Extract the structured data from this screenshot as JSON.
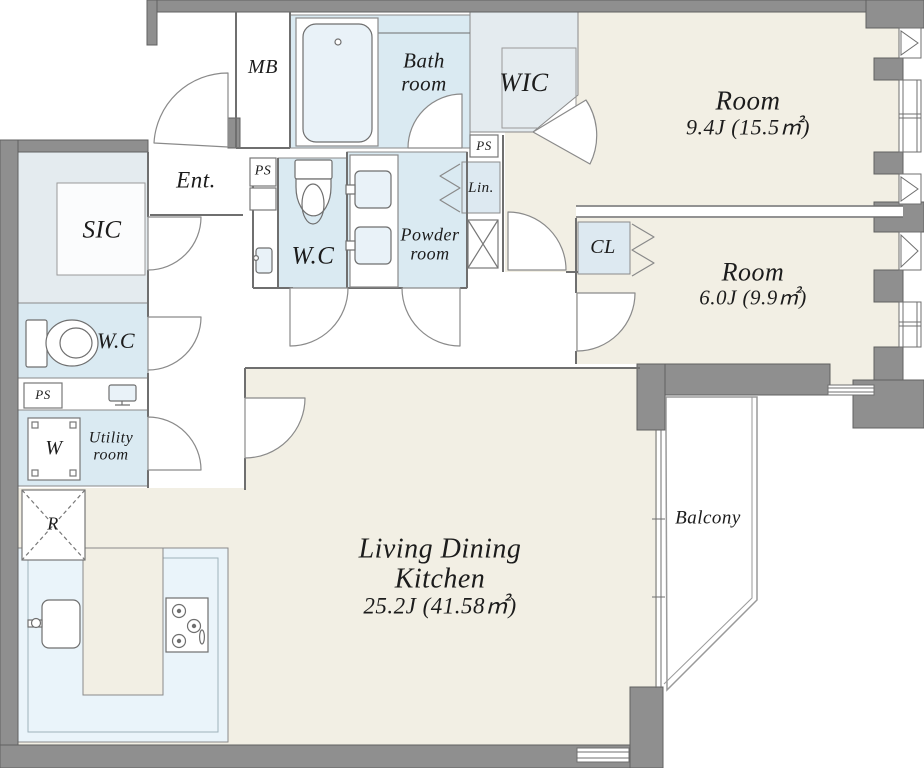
{
  "title": "Apartment floor plan",
  "colors": {
    "wall": "#8f8f8f",
    "wallEdge": "#606060",
    "floor": "#f2efe4",
    "wet": "#daeaf2",
    "closet": "#e4ebef",
    "kitchen": "#eaf4fa",
    "blue": "#dde9f1",
    "line": "#6f6f6f",
    "text": "#1c1c1c"
  },
  "rooms": {
    "living": {
      "line1": "Living Dining",
      "line2": "Kitchen",
      "area": "25.2J (41.58㎡)"
    },
    "bedroom1": {
      "name": "Room",
      "area": "9.4J (15.5㎡)"
    },
    "bedroom2": {
      "name": "Room",
      "area": "6.0J (9.9㎡)"
    },
    "bathroom": {
      "line1": "Bath",
      "line2": "room"
    },
    "powder": {
      "line1": "Powder",
      "line2": "room"
    },
    "utility": {
      "line1": "Utility",
      "line2": "room"
    },
    "entrance": {
      "name": "Ent."
    },
    "sic": {
      "name": "SIC"
    },
    "wic": {
      "name": "WIC"
    },
    "closet": {
      "name": "CL"
    },
    "linen": {
      "name": "Lin."
    },
    "wc_left": {
      "name": "W.C"
    },
    "wc_center": {
      "name": "W.C"
    },
    "balcony": {
      "name": "Balcony"
    },
    "meter_box": {
      "name": "MB"
    }
  },
  "fixtures": {
    "pipe_space": "PS",
    "washer": "W",
    "refrigerator": "R"
  }
}
